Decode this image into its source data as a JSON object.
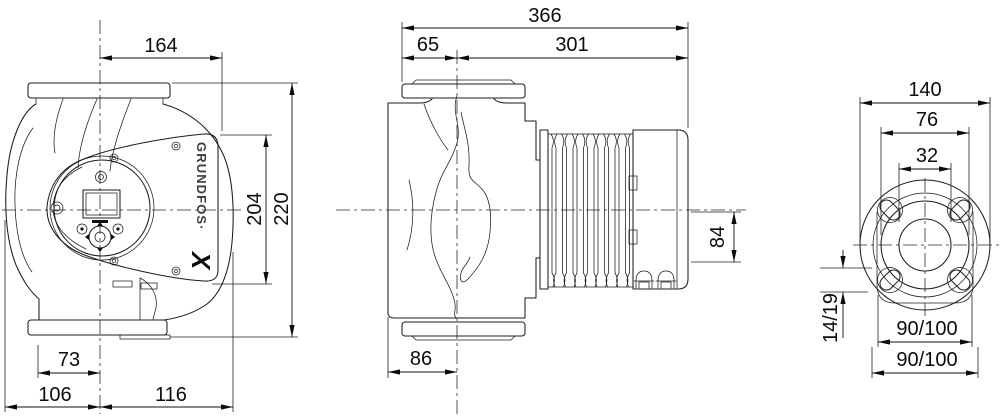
{
  "brand": {
    "wordmark": "GRUNDFOS·",
    "symbol": "X"
  },
  "front_view": {
    "dim_width_top": "164",
    "dim_height_inner": "204",
    "dim_height_overall": "220",
    "dim_foot": "73",
    "dim_left_of_axis": "106",
    "dim_right_of_axis": "116"
  },
  "side_view": {
    "dim_overall_length": "366",
    "dim_flange_to_axis": "65",
    "dim_axis_to_end": "301",
    "dim_body": "86",
    "dim_axis_to_bottom": "84"
  },
  "flange_view": {
    "dim_flange_od": "140",
    "dim_face": "76",
    "dim_bore": "32",
    "dim_slot": "14/19",
    "dim_bolt_span_inner": "90/100",
    "dim_bolt_span_outer": "90/100"
  }
}
